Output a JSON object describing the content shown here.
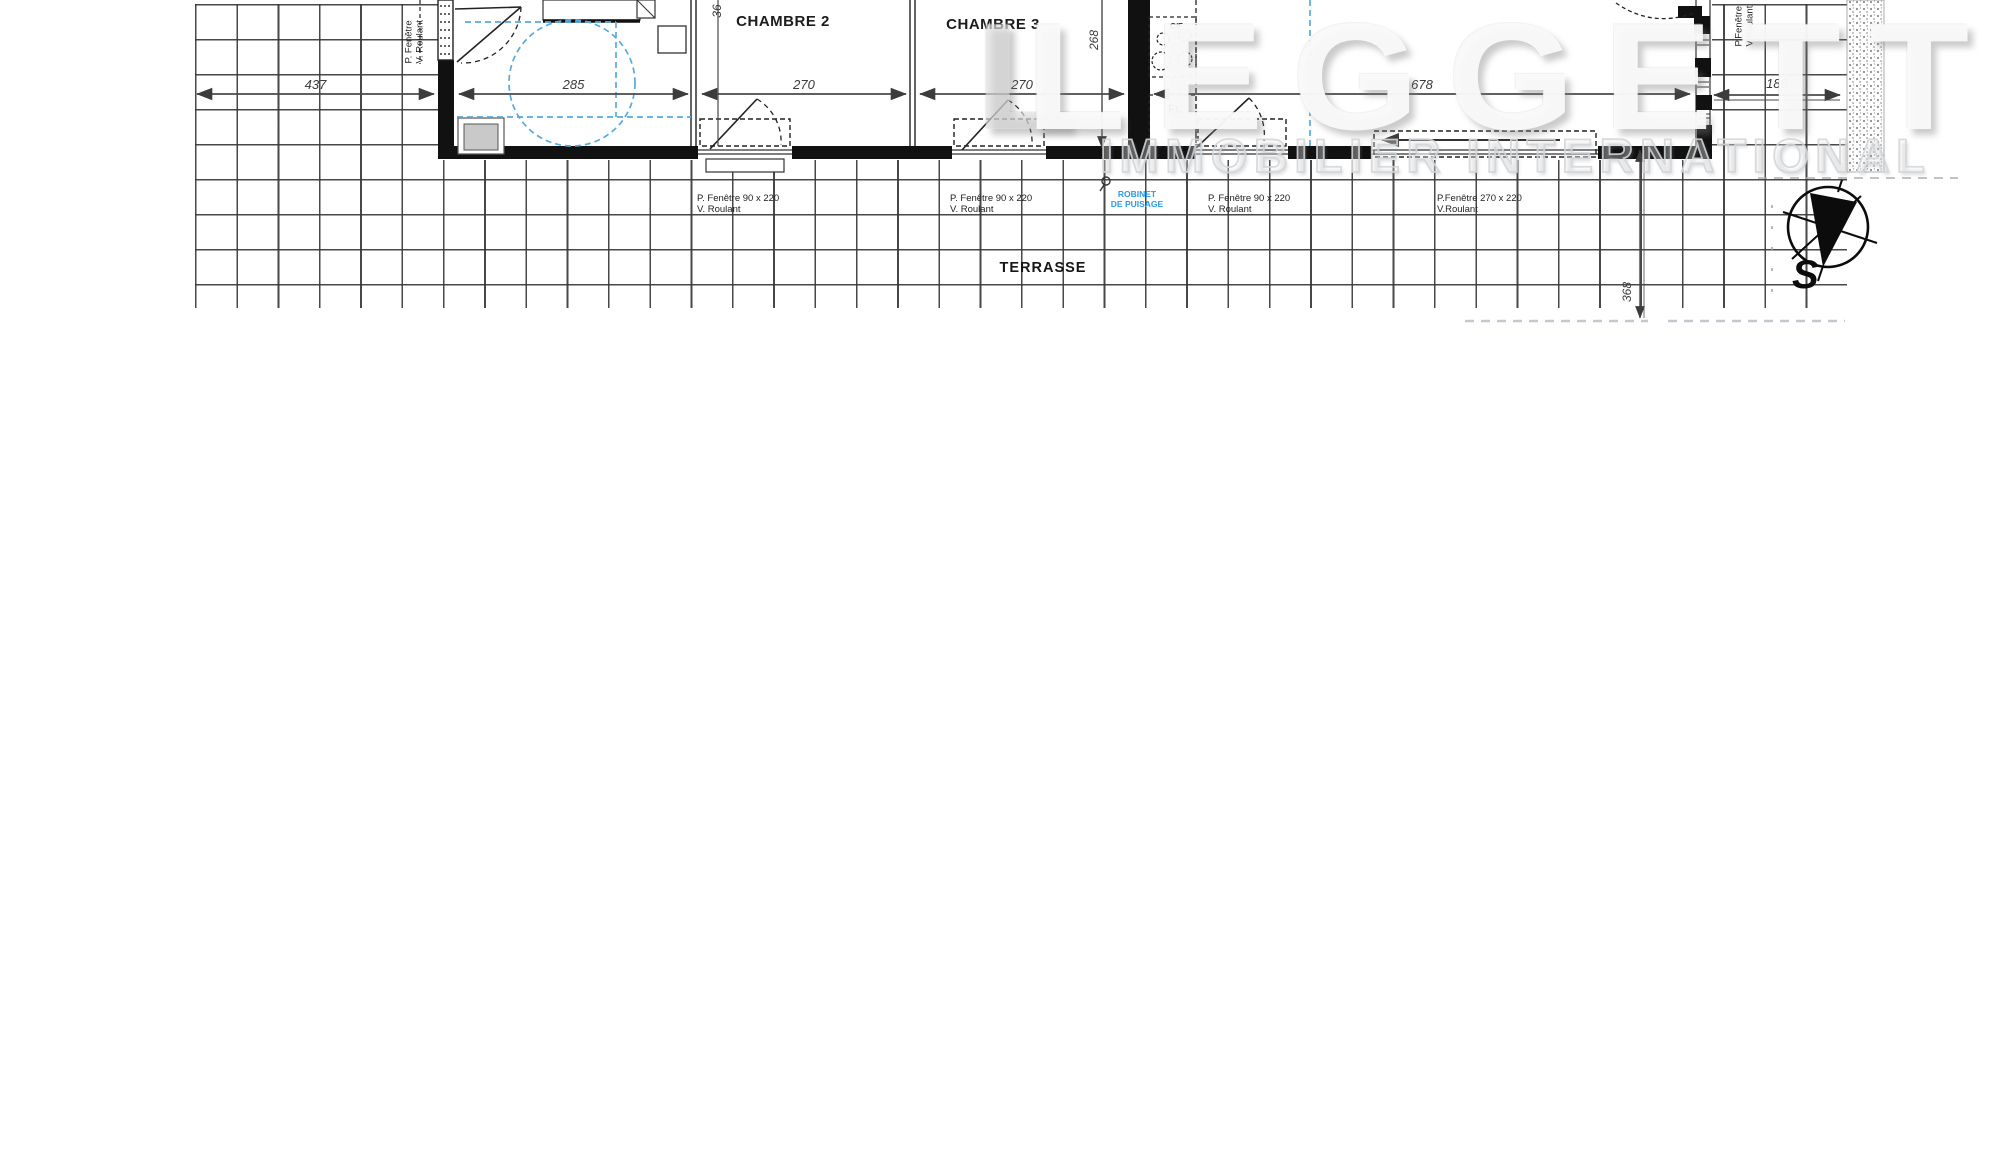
{
  "plan": {
    "room_labels": {
      "chambre2": "CHAMBRE 2",
      "chambre3": "CHAMBRE 3"
    },
    "area_labels": {
      "terrasse": "TERRASSE"
    },
    "dims": {
      "w437": "437",
      "w285": "285",
      "w270a": "270",
      "w270b": "270",
      "w678": "678",
      "w188": "188",
      "h268": "268",
      "h36": "36",
      "t368": "368"
    },
    "window_labels": {
      "w1_line1": "P. Fenêtre  90 x 220",
      "w1_line2": "V. Roulant",
      "w2_line1": "P. Fenêtre  90 x 220",
      "w2_line2": "V. Roulant",
      "w3_line1": "P. Fenêtre  90 x 220",
      "w3_line2": "V. Roulant",
      "w4_line1": "P.Fenêtre  270 x 220",
      "w4_line2": "V.Roulant",
      "left_line1": "P. Fenêtre",
      "left_line2": "V. Roulant",
      "right_line1": "P.Fenêtre",
      "right_line2": "V.Roulant"
    },
    "annotations": {
      "robinet_line1": "ROBINET",
      "robinet_line2": "DE PUISAGE",
      "fridge": "Fr.",
      "hob": "C/F"
    },
    "compass": {
      "south": "S"
    }
  },
  "watermark": {
    "l": "L",
    "name": "LEGGETT",
    "subtitle": "IMMOBILIER INTERNATIONAL"
  },
  "colors": {
    "annotation_blue": "#2b9ce8",
    "guide_blue": "#5aa9dd",
    "wall_black": "#111111",
    "grid_grey": "#383838",
    "dim_grey": "#4a4a4a"
  }
}
